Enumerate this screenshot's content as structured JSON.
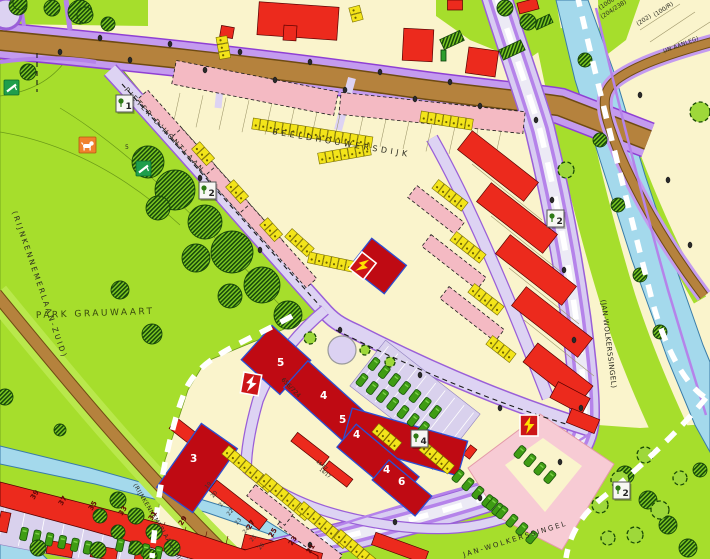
{
  "map": {
    "palette": {
      "parcel_cream": "#FAF4CC",
      "park_green": "#A6DE2C",
      "water_blue": "#A4D9EC",
      "road_brown": "#B5823D",
      "sidewalk_purple": "#C49BEF",
      "street_lavender": "#DDD3F3",
      "bike_purple": "#B583EA",
      "building_red": "#EC2A1D",
      "building_dark_red": "#BF0A13",
      "building_blue_outline": "#2B4FD4",
      "planned_pink": "#F4BAC3",
      "planned_pink_light": "#F7CBD4",
      "parking_yellow": "#F3E41A",
      "car_green": "#3F9C14",
      "tree_dark_green": "#1E5208",
      "boundary_dash_white": "#FFFFFF",
      "icon_orange": "#F0812C",
      "icon_green": "#1F9E4C",
      "transformer_red": "#CC1518",
      "bolt_yellow": "#FFE000"
    },
    "street_labels": [
      {
        "t": "BEELDHOUWERSDIJK",
        "x": 272,
        "y": 134,
        "r": 9.5,
        "s": 8,
        "sp": 3.5,
        "c": "#2B2B20"
      },
      {
        "t": "PIETER-D'HONTLAAN",
        "x": 124,
        "y": 90,
        "r": 47,
        "s": 7,
        "sp": 2.4,
        "c": "#2B2B20"
      },
      {
        "t": "PARK GRAUWAART",
        "x": 36,
        "y": 318,
        "r": -2,
        "s": 9,
        "sp": 2.5,
        "c": "#394A0E"
      },
      {
        "t": "(RIJNKENNEMERLAAN-ZUID)",
        "x": 12,
        "y": 212,
        "r": 71,
        "s": 7.5,
        "sp": 2.2,
        "c": "#2B2B20"
      },
      {
        "t": "(RIJNKENNEMERLAAN-ZUID)",
        "x": 133,
        "y": 485,
        "r": 59,
        "s": 6,
        "sp": 0.5,
        "c": "#2B2B20"
      },
      {
        "t": "(JAN-WOLKERSSINGEL)",
        "x": 601,
        "y": 300,
        "r": 83,
        "s": 7,
        "sp": 0.5,
        "c": "#2B2B20"
      },
      {
        "t": "JAN-WOLKERSSINGEL",
        "x": 464,
        "y": 557,
        "r": -17,
        "s": 7,
        "sp": 2,
        "c": "#2B2B20"
      },
      {
        "t": "(IN AANLEG)",
        "x": 664,
        "y": 53,
        "r": -21,
        "s": 5.5,
        "sp": 0.3,
        "c": "#2B2B20"
      }
    ],
    "parcel_labels": [
      {
        "t": "(1000L)",
        "x": 600,
        "y": 10,
        "r": -33,
        "s": 6
      },
      {
        "t": "(204/238)",
        "x": 602,
        "y": 19,
        "r": -33,
        "s": 6
      },
      {
        "t": "(202)",
        "x": 638,
        "y": 26,
        "r": -33,
        "s": 6
      },
      {
        "t": "(100/R)",
        "x": 655,
        "y": 17,
        "r": -33,
        "s": 6
      },
      {
        "t": "656/724",
        "x": 281,
        "y": 380,
        "r": 46,
        "s": 6
      },
      {
        "t": "15/17",
        "x": 316,
        "y": 462,
        "r": 40,
        "s": 4.5
      },
      {
        "t": "16/17",
        "x": 319,
        "y": 470,
        "r": 40,
        "s": 4.5
      },
      {
        "t": "5",
        "x": 125,
        "y": 149,
        "r": 0,
        "s": 6
      }
    ],
    "storey_numbers": [
      {
        "t": "5",
        "x": 277,
        "y": 366
      },
      {
        "t": "4",
        "x": 320,
        "y": 399
      },
      {
        "t": "5",
        "x": 339,
        "y": 423
      },
      {
        "t": "4",
        "x": 353,
        "y": 438
      },
      {
        "t": "3",
        "x": 190,
        "y": 462
      },
      {
        "t": "4",
        "x": 383,
        "y": 473
      },
      {
        "t": "6",
        "x": 398,
        "y": 485
      }
    ],
    "house_numbers_strip": [
      {
        "t": "39",
        "x": 34,
        "y": 500
      },
      {
        "t": "37",
        "x": 62,
        "y": 506
      },
      {
        "t": "35",
        "x": 92,
        "y": 511
      },
      {
        "t": "33",
        "x": 122,
        "y": 516
      },
      {
        "t": "31",
        "x": 152,
        "y": 521
      },
      {
        "t": "29",
        "x": 182,
        "y": 526
      },
      {
        "t": "27",
        "x": 250,
        "y": 530
      },
      {
        "t": "25",
        "x": 272,
        "y": 538
      },
      {
        "t": "23",
        "x": 292,
        "y": 546
      },
      {
        "t": "21",
        "x": 310,
        "y": 554
      }
    ],
    "house_numbers_parcels": [
      {
        "t": "19",
        "x": 207,
        "y": 489
      },
      {
        "t": "20",
        "x": 213,
        "y": 498
      },
      {
        "t": "21",
        "x": 221,
        "y": 507
      },
      {
        "t": "22",
        "x": 229,
        "y": 516
      },
      {
        "t": "23",
        "x": 237,
        "y": 525
      },
      {
        "t": "24",
        "x": 245,
        "y": 534
      },
      {
        "t": "25",
        "x": 252,
        "y": 542
      },
      {
        "t": "26",
        "x": 260,
        "y": 550
      }
    ],
    "markers": [
      {
        "label": "1",
        "x": 116,
        "y": 95
      },
      {
        "label": "2",
        "x": 199,
        "y": 182
      },
      {
        "label": "2",
        "x": 547,
        "y": 210
      },
      {
        "label": "4",
        "x": 411,
        "y": 430
      },
      {
        "label": "2",
        "x": 613,
        "y": 482
      }
    ],
    "icons": [
      {
        "name": "dog-walking-area-icon",
        "x": 79,
        "y": 137
      },
      {
        "name": "playground-icon",
        "x": 4,
        "y": 80
      },
      {
        "name": "playground-icon",
        "x": 136,
        "y": 161
      },
      {
        "name": "transformer-lightning-icon",
        "x": 244,
        "y": 372,
        "rot": 10,
        "variant": "white"
      },
      {
        "name": "transformer-lightning-icon",
        "x": 520,
        "y": 415,
        "rot": 0,
        "variant": "yellow"
      },
      {
        "name": "transformer-lightning-icon",
        "x": 362,
        "y": 252,
        "rot": 38,
        "variant": "yellow"
      },
      {
        "name": "traffic-sign-icon",
        "x": 441,
        "y": 50
      }
    ],
    "regions": [
      {
        "name": "Park Grauwaart",
        "type": "park"
      },
      {
        "name": "canal",
        "type": "water"
      },
      {
        "name": "channel",
        "type": "water"
      }
    ]
  }
}
